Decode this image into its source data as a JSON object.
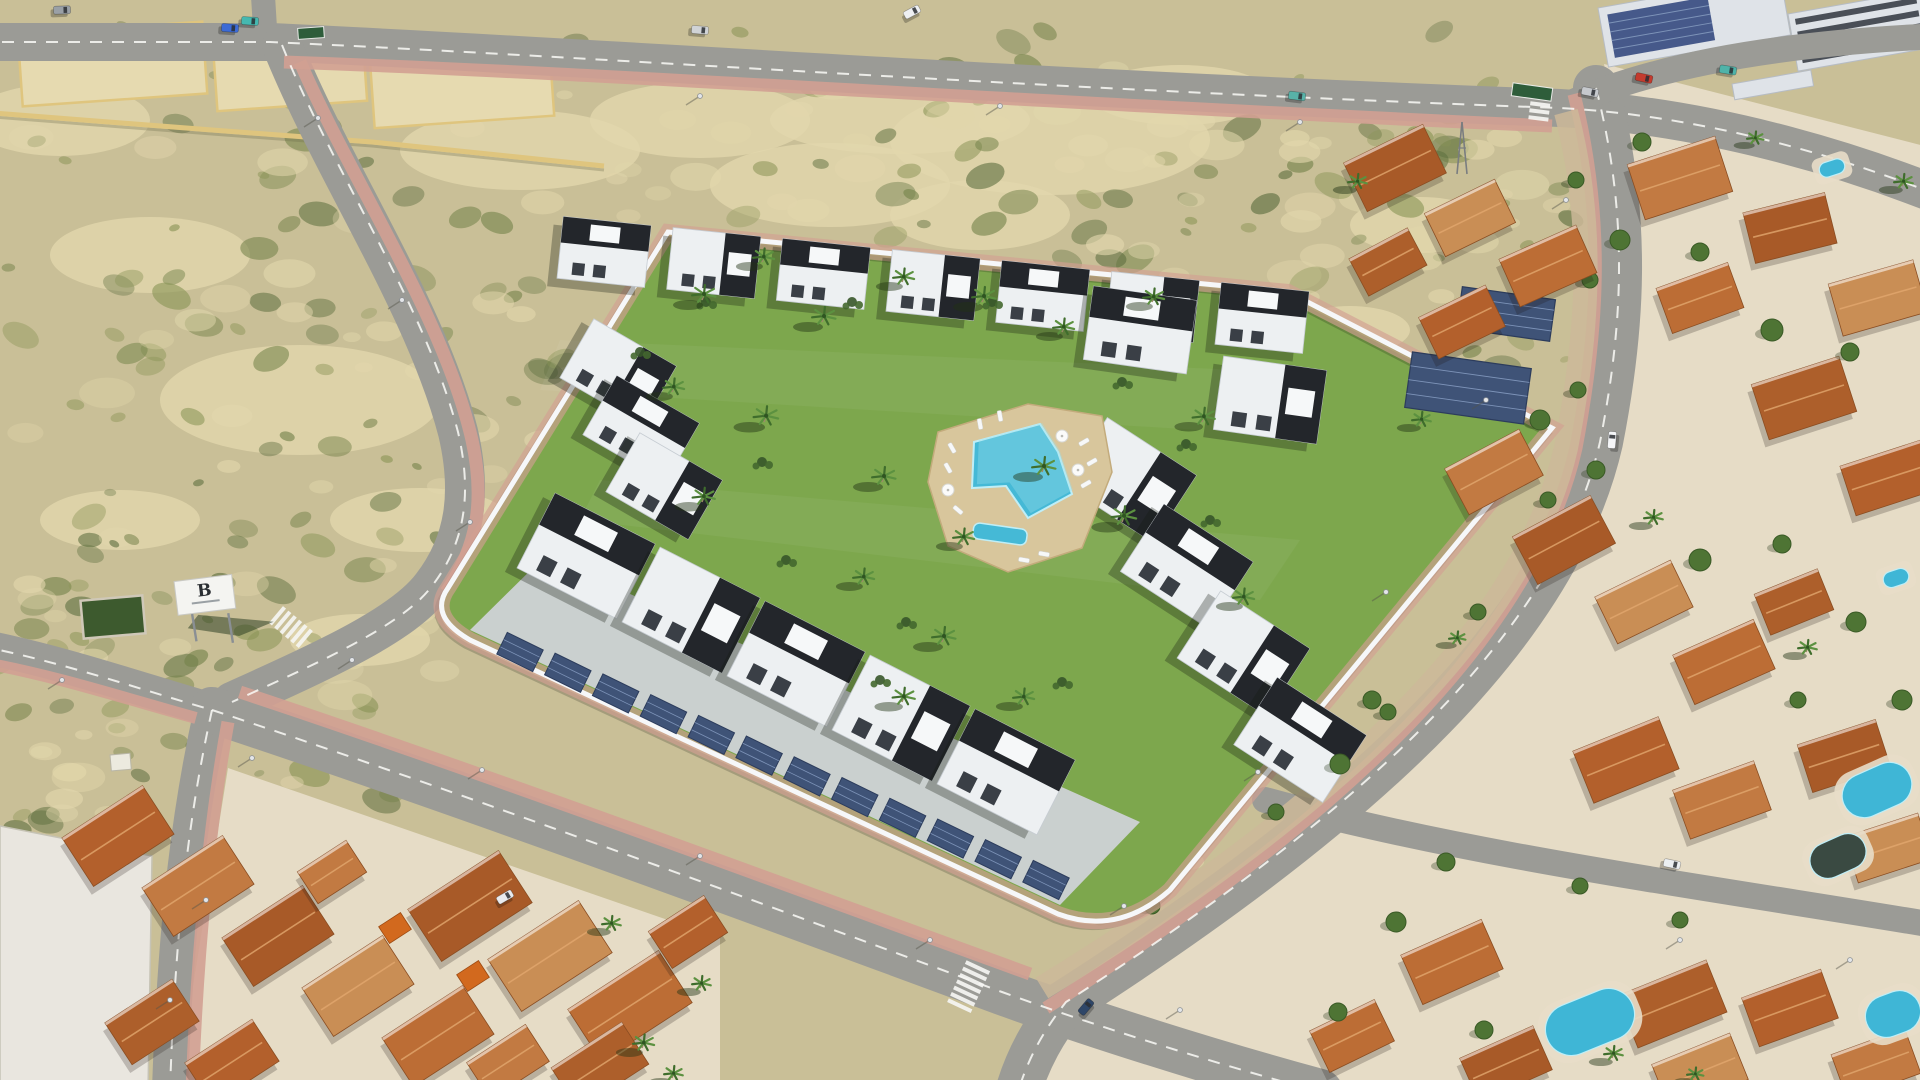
{
  "meta": {
    "title": "Aerial render of a modern gated residential development with central pool garden, surrounded by roads, vacant scrub plots and terracotta-roofed villas"
  },
  "billboard": {
    "letter": "B"
  },
  "palette": {
    "ground": "#c9bf97",
    "sand": "#e2d7ac",
    "scrub_greens": [
      "#75834b",
      "#8a9456",
      "#5d6e3f"
    ],
    "road": "#9b9b96",
    "road_line": "#fafaf7",
    "sidewalk": "#d2a092",
    "gravel": "#cdb999",
    "lawn": "#7da74d",
    "paving": "#cfd2d6",
    "building_white": "#edf0f2",
    "building_black": "#23262b",
    "wall_white": "#f6f7f9",
    "pool_water": "#45b9d6",
    "pool_light": "#9adfec",
    "pool_deck": "#d8c69c",
    "solar": "#3f5377",
    "terracotta": [
      "#b3602c",
      "#c27a42",
      "#a85a28",
      "#c98e55",
      "#bc6d35",
      "#ad5f2b"
    ],
    "tree": "#4e7434",
    "palm": "#3f6d2c",
    "villa_base": "#e6dcc6",
    "sign_green": "#2e5d3a"
  },
  "ground": {
    "sand_patches": [
      [
        1050,
        140,
        160,
        55
      ],
      [
        830,
        185,
        120,
        42
      ],
      [
        300,
        400,
        140,
        55
      ],
      [
        150,
        255,
        100,
        38
      ],
      [
        520,
        150,
        120,
        40
      ],
      [
        980,
        215,
        90,
        35
      ],
      [
        700,
        120,
        110,
        38
      ],
      [
        1180,
        95,
        90,
        30
      ],
      [
        420,
        520,
        90,
        32
      ],
      [
        120,
        520,
        80,
        30
      ],
      [
        60,
        120,
        90,
        36
      ],
      [
        360,
        640,
        70,
        26
      ],
      [
        1420,
        225,
        70,
        28
      ],
      [
        1350,
        330,
        60,
        24
      ],
      [
        60,
        960,
        60,
        40
      ],
      [
        900,
        120,
        130,
        34
      ]
    ],
    "scrub_regions": [
      [
        0,
        60,
        620,
        560,
        84,
        36
      ],
      [
        600,
        60,
        960,
        220,
        62,
        48
      ],
      [
        0,
        560,
        440,
        240,
        46,
        22
      ],
      [
        1292,
        115,
        270,
        330,
        30,
        14
      ],
      [
        0,
        780,
        125,
        290,
        18,
        8
      ],
      [
        1080,
        840,
        220,
        160,
        16,
        8
      ]
    ]
  },
  "parcels": {
    "list": [
      [
        20,
        28,
        185,
        72,
        -4
      ],
      [
        215,
        40,
        150,
        66,
        -4
      ],
      [
        372,
        52,
        180,
        70,
        -4
      ]
    ],
    "wall": "M -20 112 L 212 130 L 372 142 L 604 166"
  },
  "roads": [
    {
      "d": "M -20 42 L 270 42 C 620 58 1010 88 1560 108 C 1710 116 1850 160 1940 196",
      "w": 38,
      "dash": true
    },
    {
      "d": "M 262 -20 L 266 44",
      "w": 24,
      "dash": false
    },
    {
      "d": "M 282 45 C 332 170 425 305 458 432 C 472 492 466 542 432 586 C 402 626 320 662 232 702",
      "w": 40,
      "dash": true
    },
    {
      "d": "M -20 646 C 62 662 142 690 212 710",
      "w": 34,
      "dash": true
    },
    {
      "d": "M 212 710 C 192 800 176 910 170 1090",
      "w": 36,
      "dash": true
    },
    {
      "d": "M 212 710 C 430 782 710 884 1002 992 C 1090 1024 1210 1062 1320 1092",
      "w": 46,
      "dash": true
    },
    {
      "d": "M 1596 88 C 1630 220 1622 330 1600 442 C 1558 625 1378 802 1066 1002 C 1044 1030 1028 1058 1018 1092",
      "w": 46,
      "dash": true
    },
    {
      "d": "M 1265 800 C 1470 856 1700 886 1940 926",
      "w": 26,
      "dash": false
    },
    {
      "d": "M 1560 108 C 1640 70 1760 44 1940 36",
      "w": 26,
      "dash": false
    }
  ],
  "sidewalks": [
    {
      "d": "M 300 62 C 352 182 444 318 472 440 C 485 500 478 546 446 592",
      "w": 13
    },
    {
      "d": "M 240 692 C 452 762 724 862 1030 974",
      "w": 13
    },
    {
      "d": "M 1574 94 C 1606 222 1598 332 1576 448 C 1534 632 1352 812 1046 1008",
      "w": 13
    },
    {
      "d": "M 284 62 C 630 74 1010 102 1552 126",
      "w": 13
    },
    {
      "d": "M 228 722 C 212 810 198 930 192 1092",
      "w": 13
    },
    {
      "d": "M -20 662 C 58 676 130 700 196 718",
      "w": 12
    }
  ],
  "verge": {
    "d": "M 1566 112 C 1596 225 1588 335 1566 448 C 1526 622 1348 800 1042 988",
    "w": 24,
    "trees": [
      [
        1576,
        180
      ],
      [
        1590,
        280
      ],
      [
        1578,
        390
      ],
      [
        1548,
        500
      ],
      [
        1478,
        612
      ],
      [
        1388,
        712
      ],
      [
        1276,
        812
      ],
      [
        1152,
        906
      ]
    ]
  },
  "crosswalks": [
    [
      292,
      628,
      -50,
      6,
      22
    ],
    [
      968,
      988,
      25,
      7,
      26
    ],
    [
      1540,
      106,
      7,
      5,
      20
    ]
  ],
  "districts": {
    "left_base": "M 228 768 L 720 938 L 720 1092 L 176 1092 Z",
    "left_west_base": "M 0 826 L 152 856 L 148 1092 L 0 1092 Z",
    "right_base": "M 1604 64 L 1940 150 L 1940 1092 L 1040 1092 L 1078 1012 C 1390 812 1568 632 1610 446 C 1630 334 1636 222 1604 64 Z",
    "left_roofs": [
      [
        118,
        836,
        96,
        58,
        -33
      ],
      [
        198,
        886,
        96,
        58,
        -33
      ],
      [
        278,
        936,
        96,
        58,
        -33
      ],
      [
        358,
        986,
        96,
        58,
        -33
      ],
      [
        438,
        1036,
        96,
        58,
        -33
      ],
      [
        152,
        1022,
        80,
        50,
        -33
      ],
      [
        232,
        1062,
        80,
        50,
        -33
      ],
      [
        332,
        872,
        58,
        38,
        -33
      ],
      [
        470,
        906,
        108,
        62,
        -33
      ],
      [
        550,
        956,
        108,
        62,
        -33
      ],
      [
        630,
        1006,
        108,
        62,
        -33
      ],
      [
        600,
        1066,
        84,
        50,
        -33
      ],
      [
        688,
        932,
        66,
        44,
        -33
      ],
      [
        508,
        1062,
        70,
        44,
        -33
      ]
    ],
    "left_orange": [
      [
        395,
        928,
        26,
        20,
        -33
      ],
      [
        473,
        976,
        26,
        20,
        -33
      ]
    ],
    "right_roofs": [
      [
        1395,
        168,
        88,
        54,
        -26
      ],
      [
        1470,
        218,
        78,
        48,
        -26
      ],
      [
        1548,
        266,
        84,
        52,
        -24
      ],
      [
        1388,
        262,
        66,
        42,
        -28
      ],
      [
        1462,
        322,
        74,
        46,
        -26
      ],
      [
        1680,
        178,
        92,
        58,
        -18
      ],
      [
        1790,
        228,
        84,
        52,
        -14
      ],
      [
        1878,
        298,
        88,
        54,
        -16
      ],
      [
        1700,
        298,
        76,
        48,
        -20
      ],
      [
        1804,
        398,
        92,
        58,
        -18
      ],
      [
        1888,
        478,
        84,
        52,
        -18
      ],
      [
        1494,
        472,
        84,
        52,
        -28
      ],
      [
        1564,
        540,
        88,
        54,
        -28
      ],
      [
        1644,
        602,
        84,
        52,
        -26
      ],
      [
        1724,
        662,
        88,
        54,
        -24
      ],
      [
        1794,
        602,
        68,
        44,
        -22
      ],
      [
        1626,
        760,
        92,
        56,
        -22
      ],
      [
        1722,
        800,
        86,
        52,
        -20
      ],
      [
        1844,
        756,
        82,
        50,
        -18
      ],
      [
        1888,
        848,
        78,
        48,
        -18
      ],
      [
        1452,
        962,
        88,
        54,
        -24
      ],
      [
        1672,
        1004,
        96,
        56,
        -22
      ],
      [
        1790,
        1008,
        84,
        52,
        -20
      ],
      [
        1876,
        1064,
        78,
        48,
        -20
      ],
      [
        1506,
        1064,
        80,
        48,
        -24
      ],
      [
        1700,
        1072,
        84,
        50,
        -22
      ],
      [
        1352,
        1036,
        72,
        46,
        -26
      ]
    ],
    "right_pools": [
      [
        1832,
        168,
        26,
        15,
        -18,
        "blue"
      ],
      [
        1877,
        790,
        72,
        44,
        -24,
        "blue"
      ],
      [
        1838,
        856,
        58,
        36,
        -24,
        "dark"
      ],
      [
        1590,
        1022,
        92,
        52,
        -22,
        "blue"
      ],
      [
        1893,
        1014,
        56,
        42,
        -20,
        "blue"
      ],
      [
        1896,
        578,
        26,
        16,
        -18,
        "blue"
      ]
    ],
    "right_trees": [
      [
        1620,
        240,
        10
      ],
      [
        1700,
        252,
        9
      ],
      [
        1772,
        330,
        11
      ],
      [
        1850,
        352,
        9
      ],
      [
        1540,
        420,
        10
      ],
      [
        1596,
        470,
        9
      ],
      [
        1700,
        560,
        11
      ],
      [
        1782,
        544,
        9
      ],
      [
        1856,
        622,
        10
      ],
      [
        1372,
        700,
        9
      ],
      [
        1340,
        764,
        10
      ],
      [
        1446,
        862,
        9
      ],
      [
        1396,
        922,
        10
      ],
      [
        1484,
        1030,
        9
      ],
      [
        1902,
        700,
        10
      ],
      [
        1642,
        142,
        9
      ],
      [
        1338,
        1012,
        9
      ],
      [
        1580,
        886,
        8
      ],
      [
        1680,
        920,
        8
      ],
      [
        1798,
        700,
        8
      ]
    ],
    "right_palms": [
      [
        1356,
        186,
        0.8
      ],
      [
        1420,
        424,
        0.8
      ],
      [
        1652,
        522,
        0.8
      ],
      [
        1806,
        652,
        0.8
      ],
      [
        1902,
        186,
        0.8
      ],
      [
        1754,
        142,
        0.7
      ],
      [
        1612,
        1058,
        0.8
      ],
      [
        1694,
        1078,
        0.7
      ],
      [
        1456,
        642,
        0.7
      ]
    ],
    "left_palms": [
      [
        642,
        1048,
        0.9
      ],
      [
        700,
        988,
        0.8
      ],
      [
        610,
        928,
        0.8
      ],
      [
        672,
        1078,
        0.8
      ]
    ]
  },
  "industrial": {
    "units": [
      [
        1598,
        8,
        185,
        60,
        -10,
        "solar"
      ],
      [
        1788,
        14,
        135,
        58,
        -10,
        "slats"
      ],
      [
        1732,
        84,
        80,
        16,
        -10,
        "plain"
      ]
    ]
  },
  "complex": {
    "wall": "M 448 588 L 668 232 L 1288 292 L 1552 428 L 1170 890 Q 1118 936 1058 914 L 470 640 Q 428 616 448 588 Z",
    "paving": "M 470 630 L 1060 905 L 1140 822 L 545 556 Z",
    "rows": [
      {
        "x1": 604,
        "y1": 252,
        "x2": 1262,
        "y2": 318,
        "n": 7,
        "w": 88,
        "h": 62,
        "rot": 6
      },
      {
        "x1": 618,
        "y1": 372,
        "x2": 664,
        "y2": 486,
        "n": 3,
        "w": 95,
        "h": 68,
        "rot": 30
      },
      {
        "x1": 586,
        "y1": 556,
        "x2": 1006,
        "y2": 772,
        "n": 5,
        "w": 112,
        "h": 84,
        "rot": 27
      },
      {
        "x1": 1130,
        "y1": 480,
        "x2": 1300,
        "y2": 740,
        "n": 4,
        "w": 106,
        "h": 80,
        "rot": 33
      },
      {
        "x1": 1140,
        "y1": 330,
        "x2": 1270,
        "y2": 400,
        "n": 2,
        "w": 104,
        "h": 74,
        "rot": 8
      }
    ],
    "carports": [
      {
        "x1": 520,
        "y1": 652,
        "x2": 1046,
        "y2": 880,
        "n": 12,
        "w": 40,
        "h": 24,
        "rot": 26
      }
    ],
    "solar_arrays": [
      [
        1468,
        388,
        120,
        56,
        8
      ],
      [
        1506,
        314,
        94,
        42,
        8
      ]
    ],
    "bushes": [
      [
        640,
        352
      ],
      [
        706,
        302
      ],
      [
        786,
        560
      ],
      [
        852,
        302
      ],
      [
        906,
        622
      ],
      [
        1122,
        382
      ],
      [
        1186,
        444
      ],
      [
        992,
        302
      ],
      [
        1062,
        682
      ],
      [
        762,
        462
      ],
      [
        1210,
        520
      ],
      [
        880,
        680
      ]
    ],
    "palms": [
      [
        702,
        300,
        1
      ],
      [
        762,
        262,
        0.9
      ],
      [
        822,
        322,
        1
      ],
      [
        902,
        282,
        0.9
      ],
      [
        982,
        302,
        1
      ],
      [
        1062,
        332,
        0.9
      ],
      [
        764,
        422,
        1.05
      ],
      [
        702,
        502,
        0.95
      ],
      [
        882,
        482,
        1
      ],
      [
        962,
        542,
        0.9
      ],
      [
        1042,
        472,
        1
      ],
      [
        1122,
        522,
        1.05
      ],
      [
        862,
        582,
        0.9
      ],
      [
        942,
        642,
        1
      ],
      [
        1022,
        702,
        0.9
      ],
      [
        902,
        702,
        0.95
      ],
      [
        1152,
        302,
        0.9
      ],
      [
        1202,
        422,
        0.95
      ],
      [
        1242,
        602,
        0.9
      ],
      [
        672,
        392,
        0.9
      ]
    ],
    "pool": {
      "deck": "M 938 432 L 1028 404 L 1102 416 L 1112 472 L 1082 548 L 1008 572 L 948 546 L 928 482 Z",
      "main": "M 974 442 L 1040 424 L 1058 452 L 1072 494 L 1028 518 L 1006 486 L 972 488 Z",
      "kid": [
        1000,
        534,
        54,
        16,
        8
      ],
      "loungers": [
        [
          952,
          448,
          60
        ],
        [
          948,
          468,
          60
        ],
        [
          958,
          510,
          40
        ],
        [
          1084,
          442,
          -30
        ],
        [
          1092,
          462,
          -30
        ],
        [
          1086,
          484,
          -30
        ],
        [
          1024,
          560,
          10
        ],
        [
          1044,
          554,
          10
        ],
        [
          980,
          424,
          80
        ],
        [
          1000,
          416,
          80
        ]
      ],
      "parasols": [
        [
          1062,
          436
        ],
        [
          1078,
          470
        ],
        [
          948,
          490
        ]
      ]
    }
  },
  "extras": {
    "green_plot": [
      82,
      598,
      62,
      38,
      -5
    ],
    "hut": [
      110,
      755,
      20,
      16,
      -5
    ],
    "pylon": [
      1462,
      148
    ],
    "signs": [
      [
        311,
        33,
        -4,
        26,
        11
      ],
      [
        1532,
        92,
        8,
        40,
        13
      ]
    ]
  },
  "lamps": [
    [
      318,
      118
    ],
    [
      402,
      300
    ],
    [
      470,
      522
    ],
    [
      352,
      660
    ],
    [
      252,
      758
    ],
    [
      206,
      900
    ],
    [
      482,
      770
    ],
    [
      700,
      856
    ],
    [
      930,
      940
    ],
    [
      1180,
      1010
    ],
    [
      1566,
      200
    ],
    [
      1486,
      400
    ],
    [
      1386,
      592
    ],
    [
      1258,
      772
    ],
    [
      1124,
      906
    ],
    [
      700,
      96
    ],
    [
      1000,
      106
    ],
    [
      1300,
      122
    ],
    [
      62,
      680
    ],
    [
      170,
      1000
    ],
    [
      1680,
      940
    ],
    [
      1850,
      960
    ]
  ],
  "cars": [
    [
      62,
      10,
      -2,
      "#9aa0a6"
    ],
    [
      230,
      28,
      4,
      "#3c6bd6"
    ],
    [
      250,
      21,
      4,
      "#45b8b0"
    ],
    [
      912,
      12,
      -28,
      "#eef0f2"
    ],
    [
      1297,
      96,
      7,
      "#58b2a8"
    ],
    [
      700,
      30,
      5,
      "#d0d3d6"
    ],
    [
      1590,
      92,
      11,
      "#c6c9cd"
    ],
    [
      1644,
      78,
      12,
      "#c43b2e"
    ],
    [
      1728,
      70,
      9,
      "#4fb3a9"
    ],
    [
      1612,
      440,
      -85,
      "#f4f5f7"
    ],
    [
      1672,
      864,
      12,
      "#eceff1"
    ],
    [
      1086,
      1007,
      -50,
      "#2e4668"
    ],
    [
      505,
      897,
      -30,
      "#e9ebee"
    ]
  ]
}
